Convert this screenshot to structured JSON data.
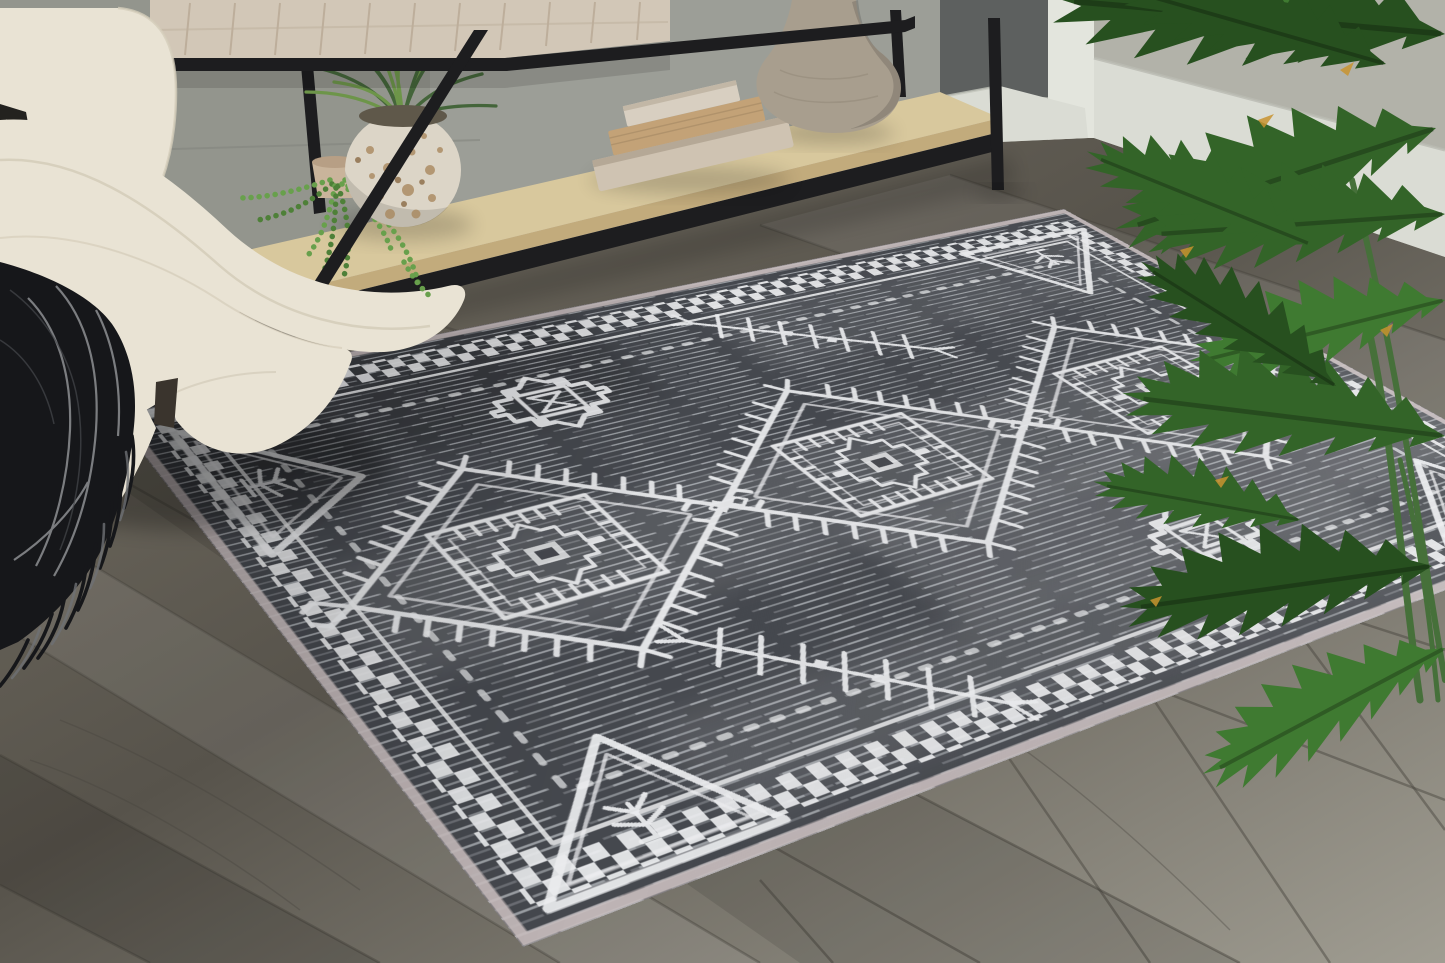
{
  "scene": {
    "type": "product-photograph",
    "description": "Living room staging photo of a charcoal gray distressed area rug with white tribal geometric pattern (diamond medallions, corner triangles, checkerboard border), beside a cream boucle sofa draped with a black fringed throw blanket, under a black metal console table with whitewashed wood top, tan wood shelf holding stacked decorative books, a stone vase, a speckled pot with spiky grass and a trailing string-of-pearls plant; gray plank wood floor, two-tone gray walls with tall white baseboard, and a large philodendron plant at the right.",
    "objects": [
      {
        "name": "area-rug",
        "pattern": "Moroccan/tribal diamond medallions with hooked edges, stepped motifs, branch motifs, corner triangles with tree glyphs, checkerboard border"
      },
      {
        "name": "sofa",
        "material": "cream boucle fabric"
      },
      {
        "name": "throw-blanket",
        "detail": "black with thin white stripes and long twisted fringe"
      },
      {
        "name": "throw-pillow",
        "detail": "black and white patterned, edge visible"
      },
      {
        "name": "console-table",
        "detail": "black metal frame, whitewashed wood cabinet, light tan lower shelf"
      },
      {
        "name": "decorative-books",
        "count": 3
      },
      {
        "name": "stone-vase"
      },
      {
        "name": "speckled-pot-with-grass-plant"
      },
      {
        "name": "string-of-pearls-plant"
      },
      {
        "name": "philodendron-plant"
      },
      {
        "name": "wood-plank-floor"
      },
      {
        "name": "wall-with-baseboard"
      }
    ]
  },
  "palette": {
    "wallLeft": "#93958d",
    "wallBack": "#9c9e97",
    "wallRight": "#b2b2a9",
    "wallDark": "#5d605f",
    "trim": "#e3e5dd",
    "baseboard": "#dadcd4",
    "floorMid": "#767165",
    "floorDark": "#57534b",
    "floorLight": "#a09d92",
    "floorSeam": "#45423b",
    "rugBase": "#45484e",
    "rugMotif": "#edeef0",
    "rugBinding": "#cbc0c1",
    "sofa": "#e9e3d4",
    "sofaShade": "#d5cdba",
    "blanket": "#16171a",
    "blanketStripe": "#cfd1d4",
    "frameBlack": "#1d1d1f",
    "cabinetWood": "#d2c7b7",
    "cabinetLine": "#b2a28d",
    "shelfTop": "#d8c89d",
    "shelfEdge": "#c2ab7c",
    "bookTop": "#d8cfc1",
    "bookMid": "#c3a277",
    "bookBottom": "#cfc3b2",
    "vase": "#a89e8e",
    "pot": "#dcd5c7",
    "potSpeckle": "#a9885f",
    "smallPot": "#c9b49b",
    "grassDark": "#44653a",
    "grassLight": "#6d9549",
    "pearls": "#68a04c",
    "pearlsDark": "#4e8038",
    "leafDark": "#27501f",
    "leafMid": "#336428",
    "leafBright": "#3f7a31",
    "leafTip": "#c8932f",
    "stem": "#46703a"
  }
}
